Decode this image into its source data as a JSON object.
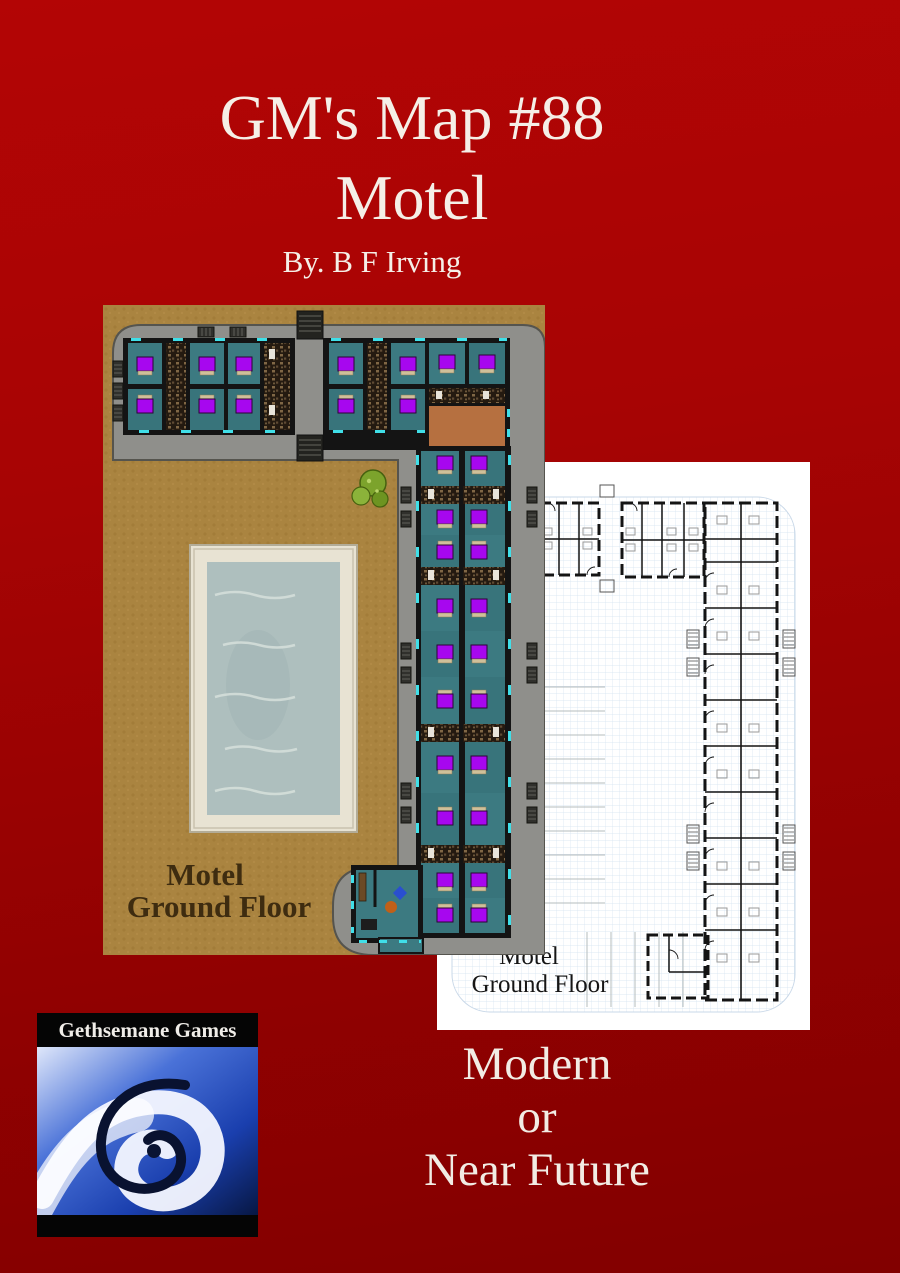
{
  "header": {
    "title_line1": "GM's Map #88",
    "title_line2": "Motel",
    "byline": "By. B F Irving"
  },
  "colored_map": {
    "label_line1": "Motel",
    "label_line2": "Ground Floor"
  },
  "blueprint": {
    "label_line1": "Motel",
    "label_line2": "Ground Floor"
  },
  "logo": {
    "publisher": "Gethsemane Games"
  },
  "footer": {
    "line1": "Modern",
    "line2": "or",
    "line3": "Near Future"
  },
  "palette": {
    "background_top": "#b30505",
    "background_bottom": "#820000",
    "title_text": "#f5efe7",
    "map_courtyard": "#aa8440",
    "map_sidewalk": "#8f8f8b",
    "map_room_floor": "#3c7a81",
    "map_bed": "#a707ef",
    "map_bathroom": "#241a10",
    "map_lobby": "#b67040",
    "map_pool_water": "#aebfbe",
    "map_pool_deck": "#e8e3d3",
    "map_tree": "#7ca32c",
    "map_door_marker": "#40dfe8",
    "map_wall": "#141414",
    "map_label_text": "#3e2c10",
    "blueprint_paper": "#ffffff",
    "blueprint_grid": "#d3e2ef",
    "blueprint_wall": "#141414",
    "logo_blue": "#2f57c9"
  }
}
